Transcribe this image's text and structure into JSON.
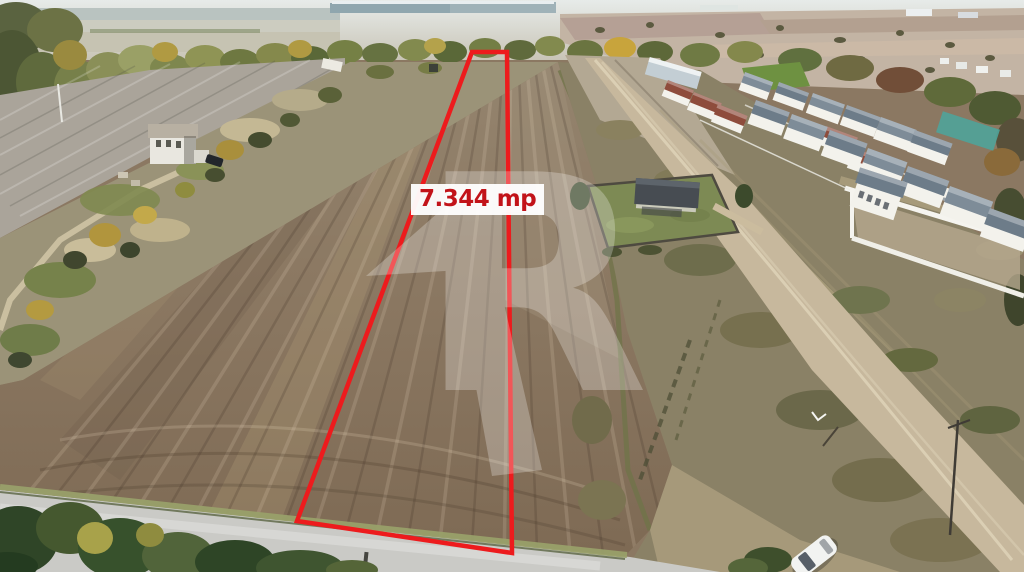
{
  "photo": {
    "alt": "Aerial drone photo of a plowed farmland plot outlined in red, beside a village with white houses, dirt tracks, autumn trees and a paved road in the foreground"
  },
  "plot_annotation": {
    "area_label": "7.344 mp",
    "outline_color": "#ed1b1d",
    "label_text_color": "#c21319",
    "label_background": "#ffffff"
  },
  "watermark": {
    "letter": "R",
    "color": "#ffffff"
  },
  "palette": {
    "sky_horizon": "#e4e9e7",
    "distant_fields": "#c9c2b3",
    "plowed_field": "#8a7660",
    "field_highlight": "#a4906f",
    "gray_field": "#aaa49a",
    "scrub": "#948d72",
    "tree_green": "#5b6939",
    "tree_autumn": "#b39a42",
    "dirt_road": "#c7b89d",
    "paved_road": "#cacac6",
    "house_roof_gray": "#71808c",
    "house_roof_red": "#8e4c3c",
    "house_wall": "#f3f2ec"
  }
}
